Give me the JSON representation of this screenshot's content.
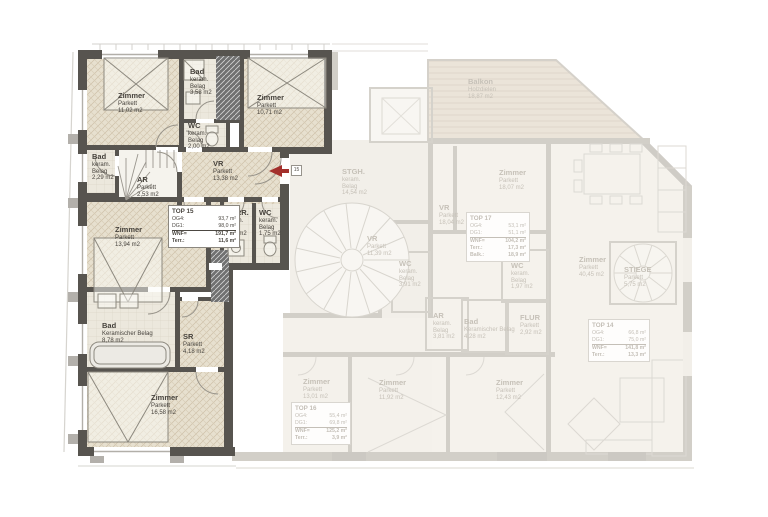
{
  "colors": {
    "accent_red": "#a3302c",
    "wall_dark": "#57544f",
    "parquet_beige": "#e7e0cf",
    "faded_text": "#c6c1b8"
  },
  "entrance": {
    "apartment_number": "15"
  },
  "top15": {
    "rooms": [
      {
        "name": "Zimmer",
        "material": "Parkett",
        "area": "11,02 m2"
      },
      {
        "name": "Bad",
        "material": "keram. Belag",
        "area": "3,58 m2"
      },
      {
        "name": "Zimmer",
        "material": "Parkett",
        "area": "10,71 m2"
      },
      {
        "name": "WC",
        "material": "keram. Belag",
        "area": "2,00 m2"
      },
      {
        "name": "Bad",
        "material": "keram. Belag",
        "area": "2,29 m2"
      },
      {
        "name": "AR",
        "material": "Parkett",
        "area": "2,53 m2"
      },
      {
        "name": "VR",
        "material": "Parkett",
        "area": "13,38 m2"
      },
      {
        "name": "Zimmer",
        "material": "Parkett",
        "area": "13,94 m2"
      },
      {
        "name": "VORR.",
        "material": "keram. Belag",
        "area": "1,89 m2"
      },
      {
        "name": "WC",
        "material": "keram. Belag",
        "area": "1,75 m2"
      },
      {
        "name": "Bad",
        "material": "Keramischer Belag",
        "area": "8,78 m2"
      },
      {
        "name": "SR",
        "material": "Parkett",
        "area": "4,18 m2"
      },
      {
        "name": "Zimmer",
        "material": "Parkett",
        "area": "16,58 m2"
      }
    ],
    "info_box": {
      "title": "TOP 15",
      "rows": [
        {
          "k": "OG4:",
          "v": "93,7 m²"
        },
        {
          "k": "DG1:",
          "v": "98,0 m²"
        },
        {
          "k": "WNF=",
          "v": "191,7 m²"
        },
        {
          "k": "Terr.:",
          "v": "11,6 m²"
        }
      ]
    }
  },
  "faded": {
    "rooms": [
      {
        "name": "Balkon",
        "material": "Holzdielen",
        "area": "18,87 m2"
      },
      {
        "name": "STGH.",
        "material": "keram. Belag",
        "area": "14,54 m2"
      },
      {
        "name": "Zimmer",
        "material": "Parkett",
        "area": "18,07 m2"
      },
      {
        "name": "VR",
        "material": "Parkett",
        "area": "18,04 m2"
      },
      {
        "name": "VR",
        "material": "Parkett",
        "area": "11,39 m2"
      },
      {
        "name": "WC",
        "material": "keram. Belag",
        "area": "3,91 m2"
      },
      {
        "name": "WC",
        "material": "keram. Belag",
        "area": "1,97 m2"
      },
      {
        "name": "AR",
        "material": "keram. Belag",
        "area": "3,81 m2"
      },
      {
        "name": "Bad",
        "material": "Keramischer Belag",
        "area": "4,28 m2"
      },
      {
        "name": "FLUR",
        "material": "Parkett",
        "area": "2,92 m2"
      },
      {
        "name": "Zimmer",
        "material": "Parkett",
        "area": "40,45 m2"
      },
      {
        "name": "STIEGE",
        "material": "Parkett",
        "area": "5,75 m2"
      },
      {
        "name": "Zimmer",
        "material": "Parkett",
        "area": "13,01 m2"
      },
      {
        "name": "Zimmer",
        "material": "Parkett",
        "area": "11,92 m2"
      },
      {
        "name": "Zimmer",
        "material": "Parkett",
        "area": "12,43 m2"
      }
    ],
    "info_boxes": [
      {
        "title": "TOP 17",
        "rows": [
          {
            "k": "OG4:",
            "v": "53,1 m²"
          },
          {
            "k": "DG1:",
            "v": "51,1 m²"
          },
          {
            "k": "WNF=",
            "v": "104,2 m²"
          },
          {
            "k": "Terr.:",
            "v": "17,3 m²"
          },
          {
            "k": "Balk.:",
            "v": "18,9 m²"
          }
        ]
      },
      {
        "title": "TOP 16",
        "rows": [
          {
            "k": "OG4:",
            "v": "55,4 m²"
          },
          {
            "k": "DG1:",
            "v": "69,8 m²"
          },
          {
            "k": "WNF=",
            "v": "125,2 m²"
          },
          {
            "k": "Terr.:",
            "v": "3,9 m²"
          }
        ]
      },
      {
        "title": "TOP 14",
        "rows": [
          {
            "k": "OG4:",
            "v": "66,8 m²"
          },
          {
            "k": "DG1:",
            "v": "75,0 m²"
          },
          {
            "k": "WNF=",
            "v": "141,8 m²"
          },
          {
            "k": "Terr.:",
            "v": "13,3 m²"
          }
        ]
      }
    ]
  }
}
